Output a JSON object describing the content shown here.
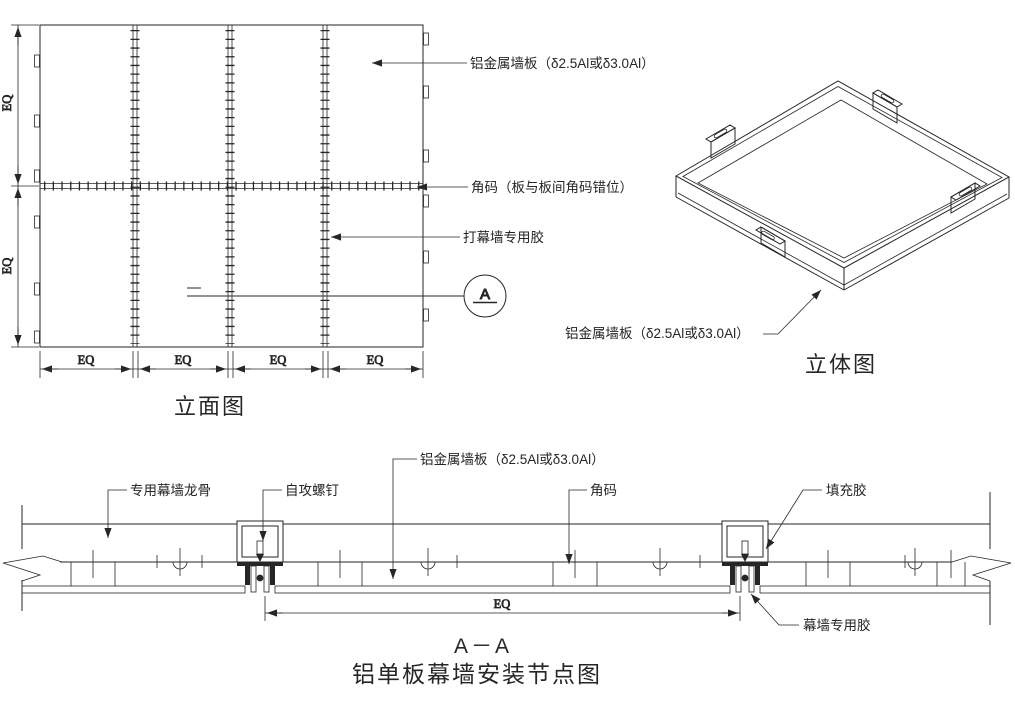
{
  "colors": {
    "line": "#262626",
    "bg": "#ffffff"
  },
  "elevation": {
    "caption": "立面图",
    "eq": "EQ",
    "labels": {
      "panel": "铝金属墙板（δ2.5Al或δ3.0Al）",
      "corner": "角码（板与板间角码错位）",
      "glue": "打幕墙专用胶",
      "section_mark": "A"
    }
  },
  "iso": {
    "caption": "立体图",
    "labels": {
      "panel": "铝金属墙板（δ2.5Al或δ3.0Al）"
    }
  },
  "section": {
    "title": "A－A",
    "caption": "铝单板幕墙安装节点图",
    "eq": "EQ",
    "labels": {
      "keel": "专用幕墙龙骨",
      "screw": "自攻螺钉",
      "panel": "铝金属墙板（δ2.5Al或δ3.0Al）",
      "corner": "角码",
      "filler": "填充胶",
      "glue": "幕墙专用胶"
    }
  }
}
